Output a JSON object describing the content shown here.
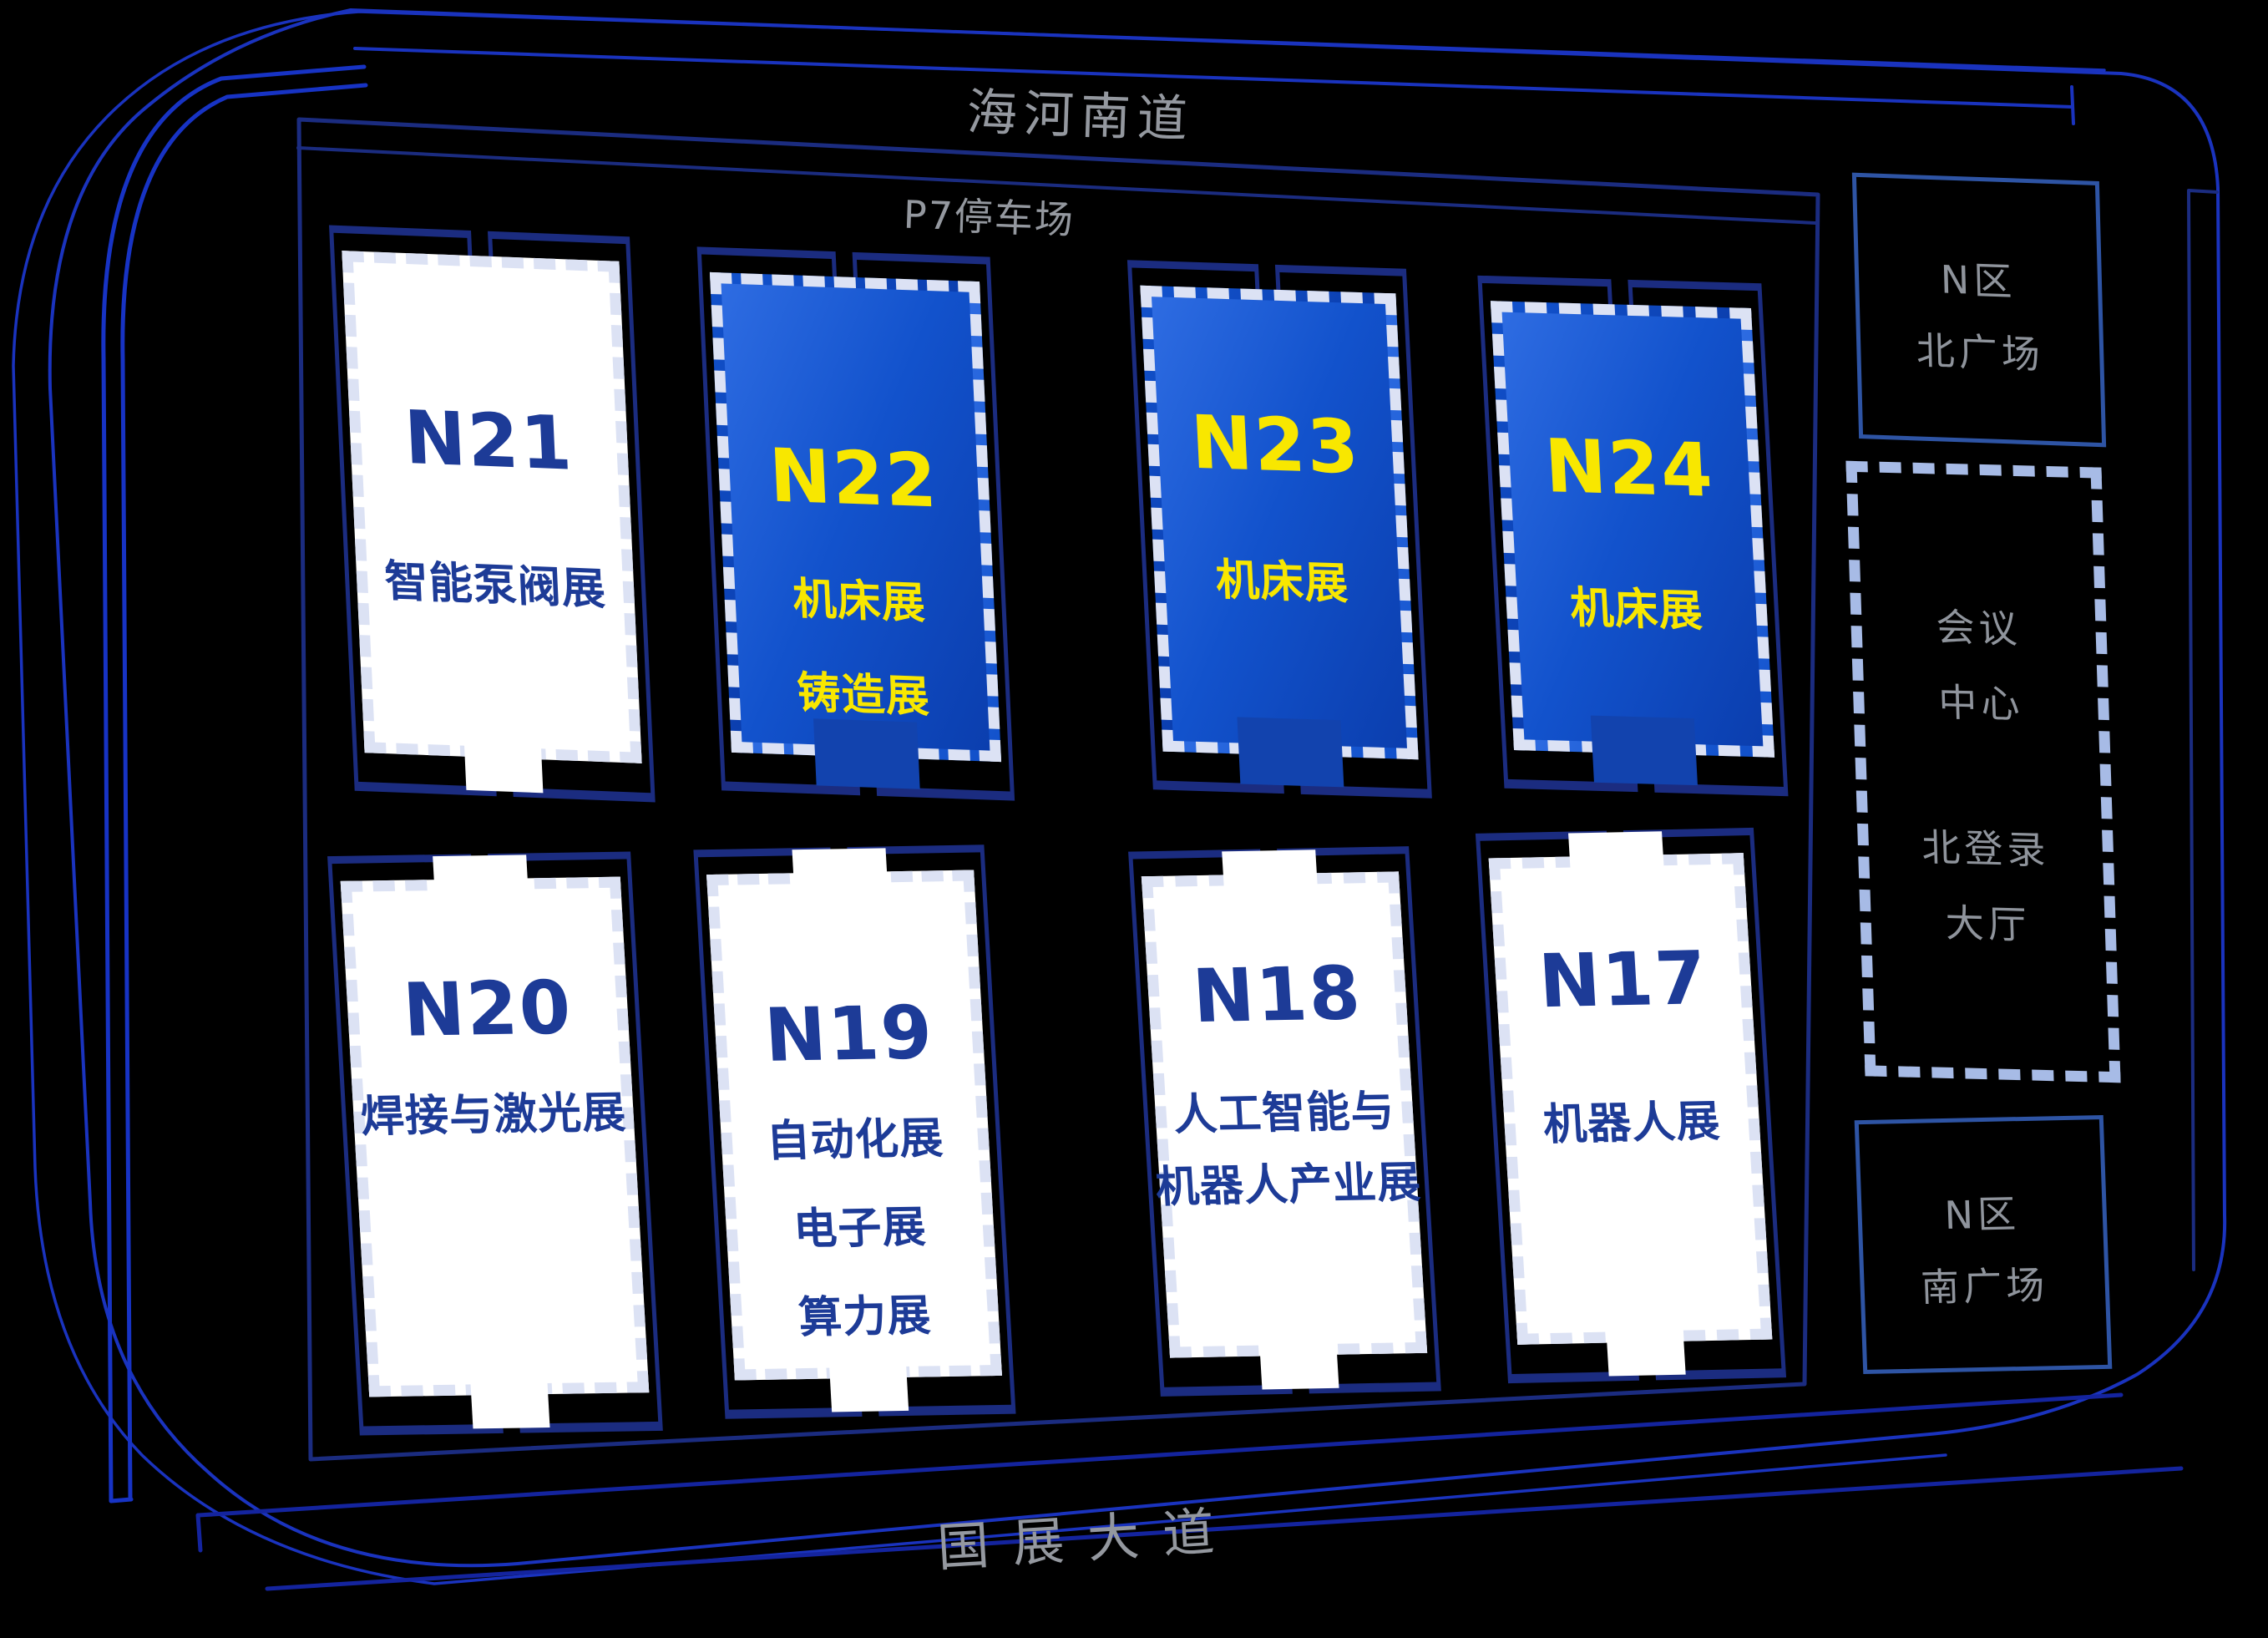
{
  "roads": {
    "top": "海河南道",
    "bottom": "国展大道"
  },
  "parking": {
    "label": "P7停车场"
  },
  "halls": {
    "n21": {
      "id": "N21",
      "lines": [
        "智能泵阀展"
      ],
      "fill": "white"
    },
    "n22": {
      "id": "N22",
      "lines": [
        "机床展",
        "铸造展"
      ],
      "fill": "blue"
    },
    "n23": {
      "id": "N23",
      "lines": [
        "机床展"
      ],
      "fill": "blue"
    },
    "n24": {
      "id": "N24",
      "lines": [
        "机床展"
      ],
      "fill": "blue"
    },
    "n20": {
      "id": "N20",
      "lines": [
        "焊接与激光展"
      ],
      "fill": "white"
    },
    "n19": {
      "id": "N19",
      "lines": [
        "自动化展",
        "电子展",
        "算力展"
      ],
      "fill": "white"
    },
    "n18": {
      "id": "N18",
      "lines": [
        "人工智能与",
        "机器人产业展"
      ],
      "fill": "white"
    },
    "n17": {
      "id": "N17",
      "lines": [
        "机器人展"
      ],
      "fill": "white"
    }
  },
  "side_areas": {
    "north_plaza": {
      "lines": [
        "N区",
        "北广场"
      ]
    },
    "conference_center": {
      "lines": [
        "会议",
        "中心",
        "北登录",
        "大厅"
      ]
    },
    "south_plaza": {
      "lines": [
        "N区",
        "南广场"
      ]
    }
  },
  "colors": {
    "background": "#000000",
    "frame_blue": "#1A33BE",
    "outline_navy": "#1B2C80",
    "hall_blue_gradient_start": "#2E6CE2",
    "hall_blue_gradient_end": "#0B3EAE",
    "hall_yellow_text": "#F8E700",
    "hall_navy_text": "#1D3B97",
    "card_dash": "#DCE2F4",
    "conference_dash": "#A7BBE6",
    "plaza_stroke": "#2E54A4",
    "road_text_gray": "#94989F",
    "entrance_tab_blue": "#1243AE"
  }
}
